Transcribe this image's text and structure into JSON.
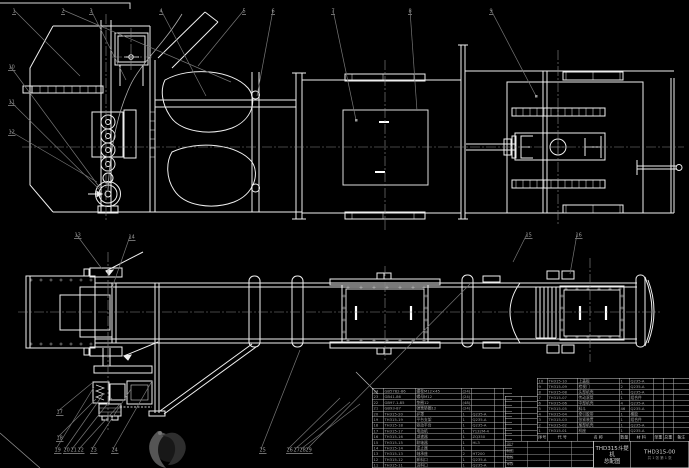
{
  "drawing": {
    "title": "THD315斗提机",
    "subtitle": "总配图",
    "drawing_no": "THD315-00",
    "sheet_note": "共 1 张  第 1 张",
    "signature_labels": [
      "设计",
      "制图",
      "校核",
      "审核"
    ],
    "bom_header": [
      "序号",
      "代  号",
      "名  称",
      "数量",
      "材  料",
      "单重",
      "总重",
      "备注"
    ],
    "right_bom_rows": [
      [
        "10",
        "TH315-10",
        "上盖板",
        "1",
        "Q235-A",
        "",
        "",
        ""
      ],
      [
        "9",
        "TH315-09",
        "检视门",
        "2",
        "Q235-A",
        "",
        "",
        ""
      ],
      [
        "8",
        "TH315-08",
        "头部机壳",
        "1",
        "Q235-A",
        "",
        "",
        ""
      ],
      [
        "7",
        "TH315-07",
        "传动滚筒",
        "1",
        "组合件",
        "",
        "",
        ""
      ],
      [
        "6",
        "TH315-06",
        "中部机壳",
        "4",
        "Q235-A",
        "",
        "",
        ""
      ],
      [
        "5",
        "TH315-05",
        "料斗",
        "46",
        "Q235-A",
        "",
        "",
        ""
      ],
      [
        "4",
        "TH315-04",
        "牵引胶带",
        "1",
        "橡胶",
        "",
        "",
        ""
      ],
      [
        "3",
        "TH315-03",
        "张紧装置",
        "1",
        "组合件",
        "",
        "",
        ""
      ],
      [
        "2",
        "TH315-02",
        "尾部机壳",
        "1",
        "Q235-A",
        "",
        "",
        ""
      ],
      [
        "1",
        "TH315-01",
        "机座",
        "1",
        "Q235-A",
        "",
        "",
        ""
      ]
    ],
    "left_bom_rows": [
      [
        "24",
        "GB5782-86",
        "螺栓M12×45",
        "(24)",
        "",
        "",
        ""
      ],
      [
        "23",
        "GB41-86",
        "螺母M12",
        "(24)",
        "",
        "",
        ""
      ],
      [
        "22",
        "GB97.1-85",
        "垫圈12",
        "(48)",
        "",
        "",
        ""
      ],
      [
        "21",
        "GB93-87",
        "弹簧垫圈12",
        "(24)",
        "",
        "",
        ""
      ],
      [
        "20",
        "TH315-20",
        "护罩",
        "1",
        "Q235-A",
        "",
        ""
      ],
      [
        "19",
        "TH315-19",
        "平台支架",
        "1",
        "Q235-A",
        "",
        ""
      ],
      [
        "18",
        "TH315-18",
        "驱动平台",
        "1",
        "Q235-A",
        "",
        ""
      ],
      [
        "17",
        "TH315-17",
        "电动机",
        "1",
        "Y132M-4",
        "",
        ""
      ],
      [
        "16",
        "TH315-16",
        "减速器",
        "1",
        "ZQ350",
        "",
        ""
      ],
      [
        "15",
        "TH315-15",
        "联轴器",
        "1",
        "HL3",
        "",
        ""
      ],
      [
        "14",
        "TH315-14",
        "逆止器",
        "1",
        "",
        "",
        ""
      ],
      [
        "13",
        "TH315-13",
        "轴承座",
        "2",
        "HT200",
        "",
        ""
      ],
      [
        "12",
        "TH315-12",
        "卸料口",
        "1",
        "Q235-A",
        "",
        ""
      ],
      [
        "11",
        "TH315-11",
        "进料口",
        "1",
        "Q235-A",
        "",
        ""
      ]
    ],
    "balloons": [
      {
        "n": "1",
        "x": 12,
        "y": 8,
        "tx": 80,
        "ty": 76
      },
      {
        "n": "2",
        "x": 61,
        "y": 8,
        "tx": 231,
        "ty": 82
      },
      {
        "n": "3",
        "x": 89,
        "y": 8,
        "tx": 126,
        "ty": 80
      },
      {
        "n": "4",
        "x": 159,
        "y": 8,
        "tx": 206,
        "ty": 96
      },
      {
        "n": "5",
        "x": 242,
        "y": 8,
        "tx": 198,
        "ty": 66
      },
      {
        "n": "6",
        "x": 271,
        "y": 8,
        "tx": 257,
        "ty": 96
      },
      {
        "n": "7",
        "x": 331,
        "y": 8,
        "tx": 356,
        "ty": 120
      },
      {
        "n": "8",
        "x": 408,
        "y": 8,
        "tx": 417,
        "ty": 111
      },
      {
        "n": "9",
        "x": 489,
        "y": 8,
        "tx": 536,
        "ty": 96
      },
      {
        "n": "10",
        "x": 8,
        "y": 64,
        "tx": 100,
        "ty": 188
      },
      {
        "n": "11",
        "x": 8,
        "y": 99,
        "tx": 101,
        "ty": 191
      },
      {
        "n": "12",
        "x": 8,
        "y": 129,
        "tx": 97,
        "ty": 182
      },
      {
        "n": "13",
        "x": 74,
        "y": 232,
        "tx": 102,
        "ty": 269
      },
      {
        "n": "14",
        "x": 128,
        "y": 234,
        "tx": 112,
        "ty": 288
      },
      {
        "n": "15",
        "x": 525,
        "y": 232,
        "tx": 513,
        "ty": 262
      },
      {
        "n": "16",
        "x": 575,
        "y": 232,
        "tx": 570,
        "ty": 274
      },
      {
        "n": "17",
        "x": 56,
        "y": 409,
        "tx": 92,
        "ty": 383
      },
      {
        "n": "18",
        "x": 56,
        "y": 435,
        "tx": 96,
        "ty": 399
      },
      {
        "n": "19",
        "x": 54,
        "y": 447,
        "tx": 94,
        "ty": 387
      },
      {
        "n": "20",
        "x": 63,
        "y": 447,
        "tx": 104,
        "ty": 393
      },
      {
        "n": "21",
        "x": 70,
        "y": 447,
        "tx": 112,
        "ty": 398
      },
      {
        "n": "22",
        "x": 77,
        "y": 447,
        "tx": 120,
        "ty": 404
      },
      {
        "n": "23",
        "x": 90,
        "y": 447,
        "tx": 131,
        "ty": 389
      },
      {
        "n": "24",
        "x": 111,
        "y": 447,
        "tx": 152,
        "ty": 381
      },
      {
        "n": "25",
        "x": 259,
        "y": 447,
        "tx": 300,
        "ty": 350
      },
      {
        "n": "26",
        "x": 286,
        "y": 447,
        "tx": 340,
        "ty": 398
      },
      {
        "n": "27",
        "x": 293,
        "y": 447,
        "tx": 350,
        "ty": 402
      },
      {
        "n": "28",
        "x": 299,
        "y": 447,
        "tx": 360,
        "ty": 404
      },
      {
        "n": "29",
        "x": 305,
        "y": 447,
        "tx": 470,
        "ty": 284
      }
    ]
  },
  "colors": {
    "background": "#000000",
    "line": "#efefef",
    "leader": "#767676",
    "centerline": "#8a8a8a",
    "table_text": "#a6a6a6",
    "title_text": "#d5d5d5"
  }
}
